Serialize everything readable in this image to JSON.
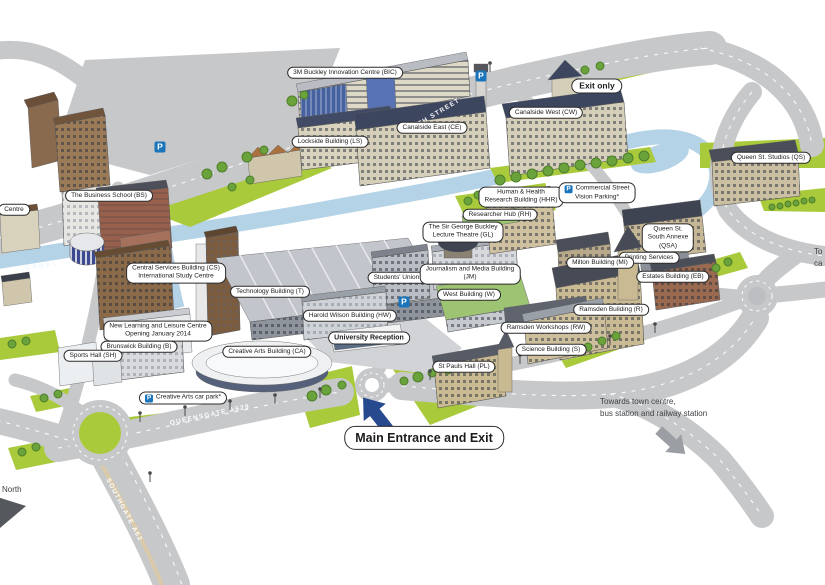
{
  "map_type": "university-campus-map",
  "colors": {
    "road": "#c7c8ca",
    "grass": "#a9ca3b",
    "water": "#b5d3e6",
    "parking_blue": "#1b75bb",
    "entrance_arrow_blue": "#274a8e",
    "towards_arrow_gray": "#9b9ea3"
  },
  "parking_glyph": "P",
  "building_labels": [
    {
      "name": "3m-buckley-innovation-centre",
      "text": "3M Buckley Innovation Centre (BIC)",
      "x": 345,
      "y": 73
    },
    {
      "name": "exit-only",
      "text": "Exit only",
      "x": 597,
      "y": 86,
      "style": "bold"
    },
    {
      "name": "canalside-west",
      "text": "Canalside West (CW)",
      "x": 546,
      "y": 113
    },
    {
      "name": "canalside-east",
      "text": "Canalside East (CE)",
      "x": 432,
      "y": 128
    },
    {
      "name": "lockside-building",
      "text": "Lockside Building (LS)",
      "x": 330,
      "y": 142
    },
    {
      "name": "queen-st-studios",
      "text": "Queen St. Studios (QS)",
      "x": 771,
      "y": 158
    },
    {
      "name": "business-school",
      "text": "The Business School (BS)",
      "x": 109,
      "y": 196
    },
    {
      "name": "human-health-research-building",
      "lines": [
        "Human & Health",
        "Research Building (HHR)"
      ],
      "x": 521,
      "y": 197
    },
    {
      "name": "commercial-street-vision-parking",
      "lines": [
        "Commercial Street",
        "Vision Parking*"
      ],
      "x": 597,
      "y": 193,
      "parking": true
    },
    {
      "name": "researcher-hub",
      "text": "Researcher Hub (RH)",
      "x": 500,
      "y": 215
    },
    {
      "name": "sir-george-buckley-lecture-theatre",
      "lines": [
        "The Sir George Buckley",
        "Lecture Theatre (GL)"
      ],
      "x": 463,
      "y": 232
    },
    {
      "name": "queen-st-south-annexe",
      "lines": [
        "Queen St.",
        "South Annexe",
        "(QSA)"
      ],
      "x": 668,
      "y": 238
    },
    {
      "name": "printing-services",
      "text": "Printing Services",
      "x": 649,
      "y": 258
    },
    {
      "name": "milton-building",
      "text": "Milton Building (MI)",
      "x": 600,
      "y": 263
    },
    {
      "name": "estates-building",
      "text": "Estates Building (EB)",
      "x": 673,
      "y": 277
    },
    {
      "name": "central-services-building",
      "lines": [
        "Central Services Building (CS)",
        "International Study Centre"
      ],
      "x": 176,
      "y": 273
    },
    {
      "name": "students-union",
      "text": "Students' Union (SU)",
      "x": 404,
      "y": 278
    },
    {
      "name": "journalism-and-media-building",
      "lines": [
        "Journalism and Media Building",
        "(JM)"
      ],
      "x": 470,
      "y": 274
    },
    {
      "name": "west-building",
      "text": "West Building (W)",
      "x": 469,
      "y": 295
    },
    {
      "name": "technology-building",
      "text": "Technology Building (T)",
      "x": 270,
      "y": 292
    },
    {
      "name": "ramsden-building",
      "text": "Ramsden Building (R)",
      "x": 611,
      "y": 310
    },
    {
      "name": "harold-wilson-building",
      "text": "Harold Wilson Building (HW)",
      "x": 350,
      "y": 316
    },
    {
      "name": "ramsden-workshops",
      "text": "Ramsden Workshops (RW)",
      "x": 546,
      "y": 328
    },
    {
      "name": "new-learning-and-leisure-centre",
      "lines": [
        "New Learning and Leisure Centre",
        "Opening January 2014"
      ],
      "x": 158,
      "y": 331
    },
    {
      "name": "university-reception",
      "text": "University Reception",
      "x": 369,
      "y": 338,
      "style": "semibold"
    },
    {
      "name": "science-building",
      "text": "Science Building (S)",
      "x": 551,
      "y": 350
    },
    {
      "name": "brunswick-building",
      "text": "Brunswick Building (B)",
      "x": 139,
      "y": 347
    },
    {
      "name": "sports-hall",
      "text": "Sports Hall (SH)",
      "x": 93,
      "y": 356
    },
    {
      "name": "creative-arts-building",
      "text": "Creative Arts Building (CA)",
      "x": 267,
      "y": 352
    },
    {
      "name": "st-pauls-hall",
      "text": "St Pauls Hall (PL)",
      "x": 464,
      "y": 367
    },
    {
      "name": "creative-arts-car-park",
      "text": "Creative Arts car park*",
      "x": 183,
      "y": 398,
      "parking": true
    },
    {
      "name": "main-entrance-and-exit",
      "text": "Main Entrance and Exit",
      "x": 424,
      "y": 438,
      "style": "large"
    }
  ],
  "free_texts": [
    {
      "name": "towards-town-centre",
      "lines": [
        "Towards town centre,",
        "bus station and railway station"
      ],
      "x": 600,
      "y": 396
    },
    {
      "name": "north-label",
      "text": "North",
      "x": 2,
      "y": 484
    }
  ],
  "partial_labels": [
    {
      "name": "left-edge-centre",
      "text": "Centre",
      "x": 14,
      "y": 210,
      "pill": true
    },
    {
      "name": "right-edge-towards",
      "lines": [
        "To",
        "ca"
      ],
      "x": 814,
      "y": 246
    }
  ],
  "road_labels": [
    {
      "name": "firth-street",
      "text": "FIRTH STREET",
      "x": 433,
      "y": 116,
      "angle": -31
    },
    {
      "name": "queensgate",
      "text": "QUEENSGATE A629",
      "x": 210,
      "y": 415,
      "angle": -12
    },
    {
      "name": "southgate",
      "text": "SOUTHGATE A62",
      "x": 124,
      "y": 510,
      "angle": 62
    },
    {
      "name": "canal",
      "text": "CANAL",
      "x": 42,
      "y": 266,
      "angle": -8,
      "style": "water"
    }
  ],
  "parking_icons": [
    {
      "name": "car-park-top-left",
      "x": 160,
      "y": 147
    },
    {
      "name": "car-park-bic",
      "x": 481,
      "y": 76
    },
    {
      "name": "car-park-centre",
      "x": 404,
      "y": 302
    }
  ]
}
